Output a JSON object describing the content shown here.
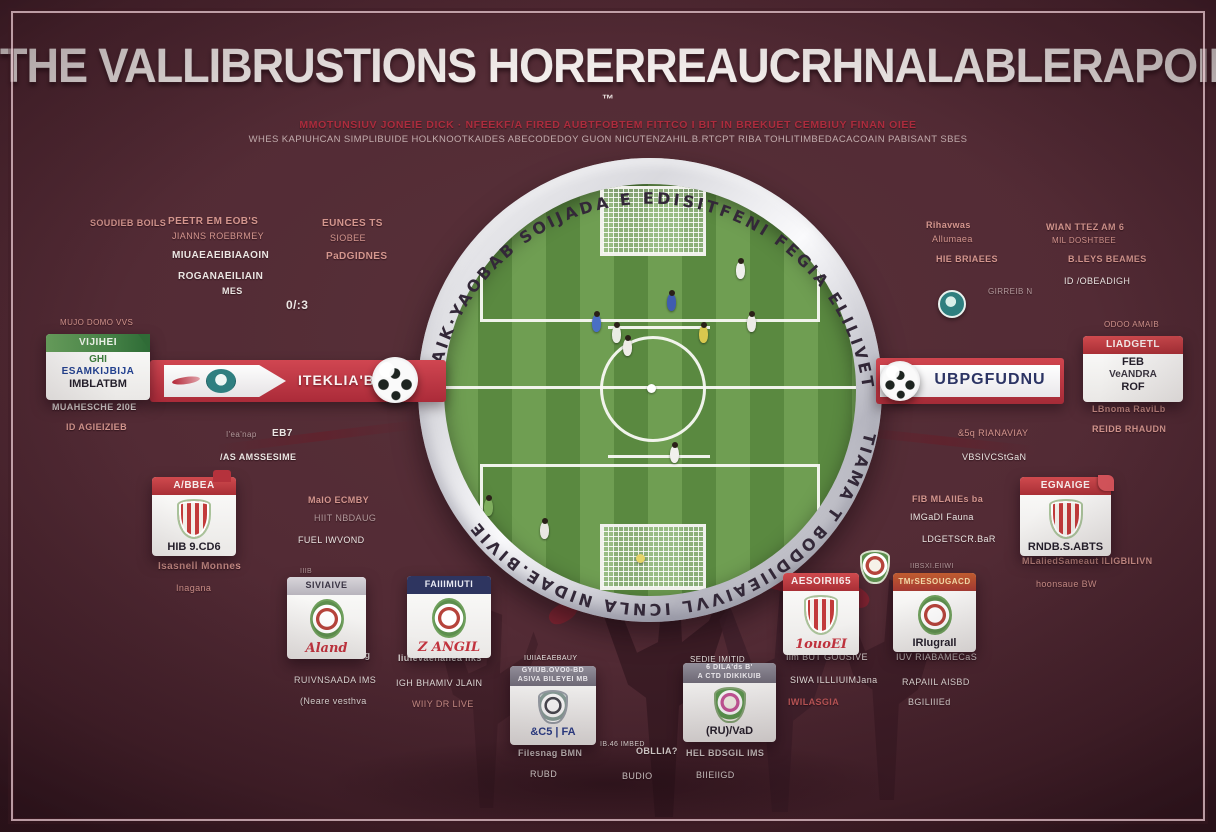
{
  "header": {
    "title": "THE VALLIBRUSTIONS HORERREAUCRHNALABLERAPOING MOTHEES",
    "tm": "™",
    "subtitle1": "MMOTUNSIUV JONEIE DICK · NFEEKF/A FIRED AUBTFOBTEM FITTCO I BIT IN BREKUET CEMBIUY FINAN OIEE",
    "subtitle2": "WHES KAPIUHCAN SIMPLIBUIDE HOLKNOOTKAIDES ABECODEDOY GUON NICUTENZAHIL.B.RTCPT RIBA TOHLITIMBEDACACOAIN PABISANT SBES"
  },
  "ring": {
    "top": "BAIK·YAOBAB  SOIJADA E EDISITFENI  FEGIA ELILIVETS",
    "bottom": "TIAMA T BODDIIEAIVVL             ICNLA NIDAE.BIVIE"
  },
  "banners": {
    "left": {
      "text": "ITEKLIA'BB S"
    },
    "right": {
      "text": "UBPGFUDNU"
    }
  },
  "colors": {
    "background": "#532b35",
    "frame": "#e2c1c9",
    "title": "#f3eeec",
    "accent_red": "#ac2c3d",
    "banner_red": "#b02c3a",
    "field_green_light": "#6f9e52",
    "field_green_dark": "#5a8940",
    "ring_silver": "#d9d9de",
    "navy": "#2e3560",
    "teal": "#2e7f7f"
  },
  "field": {
    "players": [
      {
        "x": 223,
        "y": 110,
        "c": "#3f5cb0"
      },
      {
        "x": 148,
        "y": 131,
        "c": "#4a6fc4"
      },
      {
        "x": 168,
        "y": 142,
        "c": "#e9ece3"
      },
      {
        "x": 179,
        "y": 155,
        "c": "#efece7"
      },
      {
        "x": 255,
        "y": 142,
        "c": "#d8c84e"
      },
      {
        "x": 303,
        "y": 131,
        "c": "#ecebe7"
      },
      {
        "x": 292,
        "y": 78,
        "c": "#f0efec"
      },
      {
        "x": 226,
        "y": 262,
        "c": "#f1f0ed"
      },
      {
        "x": 40,
        "y": 315,
        "c": "#7fae5e"
      },
      {
        "x": 96,
        "y": 338,
        "c": "#e9e7e2"
      }
    ],
    "balls": [
      {
        "x": 203,
        "y": 200,
        "c": "#ffffff"
      },
      {
        "x": 192,
        "y": 370,
        "c": "#e6d468"
      }
    ]
  },
  "labels": [
    {
      "t": "SOUDIEB BOILS",
      "x": 90,
      "y": 218,
      "s": 9,
      "c": "salmon",
      "b": 1
    },
    {
      "t": "PEETR EM EOB'S",
      "x": 168,
      "y": 216,
      "s": 10,
      "c": "salmon",
      "b": 1
    },
    {
      "t": "JIANNS ROEBRMEY",
      "x": 172,
      "y": 231,
      "s": 9,
      "c": "salmon"
    },
    {
      "t": "EUNCES TS",
      "x": 322,
      "y": 218,
      "s": 10,
      "c": "salmon",
      "b": 1
    },
    {
      "t": "SIOBEE",
      "x": 330,
      "y": 233,
      "s": 9,
      "c": "salmon"
    },
    {
      "t": "MIUAEAEIBIAAOIN",
      "x": 172,
      "y": 250,
      "s": 10,
      "c": "white",
      "b": 1
    },
    {
      "t": "PaDGIDNES",
      "x": 326,
      "y": 251,
      "s": 10,
      "c": "salmon",
      "b": 1
    },
    {
      "t": "ROGANAEILIAIN",
      "x": 178,
      "y": 271,
      "s": 10,
      "c": "white",
      "b": 1
    },
    {
      "t": "MES",
      "x": 222,
      "y": 286,
      "s": 9,
      "c": "white",
      "b": 1
    },
    {
      "t": "0/:3",
      "x": 286,
      "y": 298,
      "s": 12,
      "c": "white",
      "b": 1
    },
    {
      "t": "MUJO DOMO VVS",
      "x": 60,
      "y": 318,
      "s": 8,
      "c": "salmon"
    },
    {
      "t": "MUAHESCHE 2I0E",
      "x": 52,
      "y": 402,
      "s": 9,
      "c": "white",
      "b": 1
    },
    {
      "t": "ID AGIEIZIEB",
      "x": 66,
      "y": 422,
      "s": 9,
      "c": "salmon",
      "b": 1
    },
    {
      "t": "I'ea'nap",
      "x": 226,
      "y": 430,
      "s": 8,
      "c": "dim"
    },
    {
      "t": "EB7",
      "x": 272,
      "y": 428,
      "s": 10,
      "c": "white",
      "b": 1
    },
    {
      "t": "/AS AMSSESIME",
      "x": 220,
      "y": 452,
      "s": 9,
      "c": "white",
      "b": 1
    },
    {
      "t": "Rihavwas",
      "x": 926,
      "y": 220,
      "s": 9,
      "c": "salmon",
      "b": 1
    },
    {
      "t": "Allumaea",
      "x": 932,
      "y": 234,
      "s": 9,
      "c": "salmon"
    },
    {
      "t": "WIAN TTEZ AM 6",
      "x": 1046,
      "y": 222,
      "s": 9,
      "c": "salmon",
      "b": 1
    },
    {
      "t": "MIL DOSHTBEE",
      "x": 1052,
      "y": 236,
      "s": 8,
      "c": "salmon"
    },
    {
      "t": "HIE BRIAEES",
      "x": 936,
      "y": 254,
      "s": 9,
      "c": "salmon",
      "b": 1
    },
    {
      "t": "B.LEYS BEAMES",
      "x": 1068,
      "y": 254,
      "s": 9,
      "c": "salmon",
      "b": 1
    },
    {
      "t": "ID /OBEADIGH",
      "x": 1064,
      "y": 276,
      "s": 9,
      "c": "white"
    },
    {
      "t": "GIRREIB N",
      "x": 988,
      "y": 287,
      "s": 8,
      "c": "dim"
    },
    {
      "t": "ODOO AMAIB",
      "x": 1104,
      "y": 320,
      "s": 8,
      "c": "salmon"
    },
    {
      "t": "LBnoma RaviLb",
      "x": 1092,
      "y": 404,
      "s": 9,
      "c": "salmon",
      "b": 1
    },
    {
      "t": "REIDB RHAUDN",
      "x": 1092,
      "y": 424,
      "s": 9,
      "c": "salmon",
      "b": 1
    },
    {
      "t": "&5q RIANAVIAY",
      "x": 958,
      "y": 428,
      "s": 9,
      "c": "salmon"
    },
    {
      "t": "VBSIVCStGaN",
      "x": 962,
      "y": 452,
      "s": 9,
      "c": "white"
    },
    {
      "t": "FIB MLAIIEs ba",
      "x": 912,
      "y": 494,
      "s": 9,
      "c": "salmon",
      "b": 1
    },
    {
      "t": "IMGaDI Fauna",
      "x": 910,
      "y": 512,
      "s": 9,
      "c": "white"
    },
    {
      "t": "LDGETSCR.BaR",
      "x": 922,
      "y": 534,
      "s": 9,
      "c": "white"
    },
    {
      "t": "Isasnell Monnes",
      "x": 158,
      "y": 561,
      "s": 10,
      "c": "salmon",
      "b": 1
    },
    {
      "t": "Inagana",
      "x": 176,
      "y": 583,
      "s": 9,
      "c": "salmon"
    },
    {
      "t": "MaIO ECMBY",
      "x": 308,
      "y": 495,
      "s": 9,
      "c": "salmon",
      "b": 1
    },
    {
      "t": "HIIT NBDAUG",
      "x": 314,
      "y": 513,
      "s": 9,
      "c": "dim"
    },
    {
      "t": "FUEL IWVOND",
      "x": 298,
      "y": 535,
      "s": 9,
      "c": "white"
    },
    {
      "t": "IIIB",
      "x": 300,
      "y": 568,
      "s": 7,
      "c": "dim"
    },
    {
      "t": "Muuanied Silinag",
      "x": 290,
      "y": 650,
      "s": 9,
      "c": "white",
      "b": 1
    },
    {
      "t": "RUIVNSAADA IMS",
      "x": 294,
      "y": 675,
      "s": 9,
      "c": "white"
    },
    {
      "t": "(Neare vesthva",
      "x": 300,
      "y": 696,
      "s": 9,
      "c": "white"
    },
    {
      "t": "Iiulevaenanea liks",
      "x": 398,
      "y": 653,
      "s": 9,
      "c": "white",
      "b": 1
    },
    {
      "t": "IGH BHAMIV JLAIN",
      "x": 396,
      "y": 678,
      "s": 9,
      "c": "white"
    },
    {
      "t": "WIIY DR LIVE",
      "x": 412,
      "y": 699,
      "s": 9,
      "c": "salmon"
    },
    {
      "t": "IUIIAEAEBAUY",
      "x": 524,
      "y": 655,
      "s": 7,
      "c": "white"
    },
    {
      "t": "Filesnag BMN",
      "x": 518,
      "y": 748,
      "s": 9,
      "c": "white",
      "b": 1
    },
    {
      "t": "RUBD",
      "x": 530,
      "y": 769,
      "s": 9,
      "c": "white"
    },
    {
      "t": "IB.46 IMBED",
      "x": 600,
      "y": 741,
      "s": 7,
      "c": "white"
    },
    {
      "t": "OBLLIA?",
      "x": 636,
      "y": 746,
      "s": 9,
      "c": "white",
      "b": 1
    },
    {
      "t": "BUDIO",
      "x": 622,
      "y": 771,
      "s": 9,
      "c": "white"
    },
    {
      "t": "SEDIE IMITID",
      "x": 690,
      "y": 655,
      "s": 8,
      "c": "white"
    },
    {
      "t": "HEL BDSGIL IMS",
      "x": 686,
      "y": 748,
      "s": 9,
      "c": "white",
      "b": 1
    },
    {
      "t": "BIIEIIGD",
      "x": 696,
      "y": 770,
      "s": 9,
      "c": "white"
    },
    {
      "t": "Iim BUT GOUSIVE",
      "x": 786,
      "y": 652,
      "s": 9,
      "c": "white"
    },
    {
      "t": "SIWA ILLLIUIMJana",
      "x": 790,
      "y": 675,
      "s": 9,
      "c": "white"
    },
    {
      "t": "IWILASGIA",
      "x": 788,
      "y": 697,
      "s": 9,
      "c": "redl",
      "b": 1
    },
    {
      "t": "IIBSXI.EIIWI",
      "x": 910,
      "y": 563,
      "s": 7,
      "c": "dim"
    },
    {
      "t": "IUV RIABAMECaS",
      "x": 896,
      "y": 652,
      "s": 9,
      "c": "white"
    },
    {
      "t": "RAPAIIL AISBD",
      "x": 902,
      "y": 677,
      "s": 9,
      "c": "white"
    },
    {
      "t": "BGILIIIEd",
      "x": 908,
      "y": 697,
      "s": 9,
      "c": "white"
    },
    {
      "t": "MLaliedSameaut ILIGBILIVN",
      "x": 1022,
      "y": 556,
      "s": 9,
      "c": "salmon",
      "b": 1
    },
    {
      "t": "hoonsaue BW",
      "x": 1036,
      "y": 579,
      "s": 9,
      "c": "salmon"
    }
  ],
  "cards": [
    {
      "name": "card-vijihei",
      "x": 46,
      "y": 334,
      "w": 104,
      "h": 66,
      "head": {
        "lines": [
          "VIJIHEI"
        ],
        "style": "green"
      },
      "fold": "tri-green",
      "crest": null,
      "body": [
        {
          "t": "GHI",
          "cls": "green"
        },
        {
          "t": "ESAMKIJBIJA",
          "cls": "blue"
        },
        {
          "t": "IMBLATBM",
          "cls": "darkb"
        }
      ]
    },
    {
      "name": "card-liadgetl",
      "x": 1083,
      "y": 336,
      "w": 100,
      "h": 66,
      "head": {
        "lines": [
          "LIADGETL"
        ],
        "style": "red"
      },
      "fold": null,
      "crest": null,
      "body": [
        {
          "t": "FEB",
          "cls": "darkb"
        },
        {
          "t": "VeANDRA",
          "cls": "dark"
        },
        {
          "t": "ROF",
          "cls": "darkb"
        }
      ]
    },
    {
      "name": "card-ajbea",
      "x": 152,
      "y": 477,
      "w": 84,
      "h": 76,
      "head": {
        "lines": [
          "A/BBEA"
        ],
        "style": "red"
      },
      "fold": "tab-red",
      "crest": "shield",
      "body": [
        {
          "t": "HIB 9.CD6",
          "cls": "darkb"
        }
      ]
    },
    {
      "name": "card-siviaive",
      "x": 287,
      "y": 577,
      "w": 79,
      "h": 68,
      "head": {
        "lines": [
          "SIVIAIVE"
        ],
        "style": "gray"
      },
      "fold": null,
      "crest": "oval",
      "body": [
        {
          "t": "Aland",
          "cls": "script"
        }
      ]
    },
    {
      "name": "card-faiiimiuti",
      "x": 407,
      "y": 576,
      "w": 84,
      "h": 67,
      "head": {
        "lines": [
          "FAIIIMIUTI"
        ],
        "style": "navy"
      },
      "fold": null,
      "crest": "oval",
      "body": [
        {
          "t": "Z ANGIL",
          "cls": "script"
        }
      ]
    },
    {
      "name": "card-gyiub",
      "x": 510,
      "y": 666,
      "w": 86,
      "h": 79,
      "head": {
        "lines": [
          "GYIUB.OVO0-BD",
          "ASIVA BILEYEI MB"
        ],
        "style": "gray2"
      },
      "fold": null,
      "crest": "mini",
      "body": [
        {
          "t": "&C5 | FA",
          "cls": "bluebold"
        }
      ]
    },
    {
      "name": "card-dilads",
      "x": 683,
      "y": 663,
      "w": 93,
      "h": 79,
      "head": {
        "lines": [
          "6 DILA'ds B'",
          "A CTD IDIKIKUIB"
        ],
        "style": "gray2"
      },
      "fold": null,
      "crest": "mini2",
      "body": [
        {
          "t": "(RU)/VaD",
          "cls": "darkb"
        }
      ]
    },
    {
      "name": "card-aesoirii",
      "x": 783,
      "y": 573,
      "w": 76,
      "h": 74,
      "head": {
        "lines": [
          "AESOIRII65"
        ],
        "style": "red"
      },
      "fold": null,
      "crest": "shield",
      "body": [
        {
          "t": "1ouoEI",
          "cls": "script"
        }
      ]
    },
    {
      "name": "card-tmrsesougacd",
      "x": 893,
      "y": 573,
      "w": 83,
      "h": 72,
      "head": {
        "lines": [
          "TMrSESOUGACD"
        ],
        "style": "orange"
      },
      "fold": null,
      "crest": "oval",
      "body": [
        {
          "t": "IRIugraIl",
          "cls": "darkb"
        }
      ]
    },
    {
      "name": "card-egnaige",
      "x": 1020,
      "y": 477,
      "w": 91,
      "h": 71,
      "head": {
        "lines": [
          "EGNAIGE"
        ],
        "style": "red"
      },
      "fold": "tri-red",
      "crest": "shield",
      "body": [
        {
          "t": "RNDB.S.ABTS",
          "cls": "darkb"
        }
      ]
    }
  ]
}
